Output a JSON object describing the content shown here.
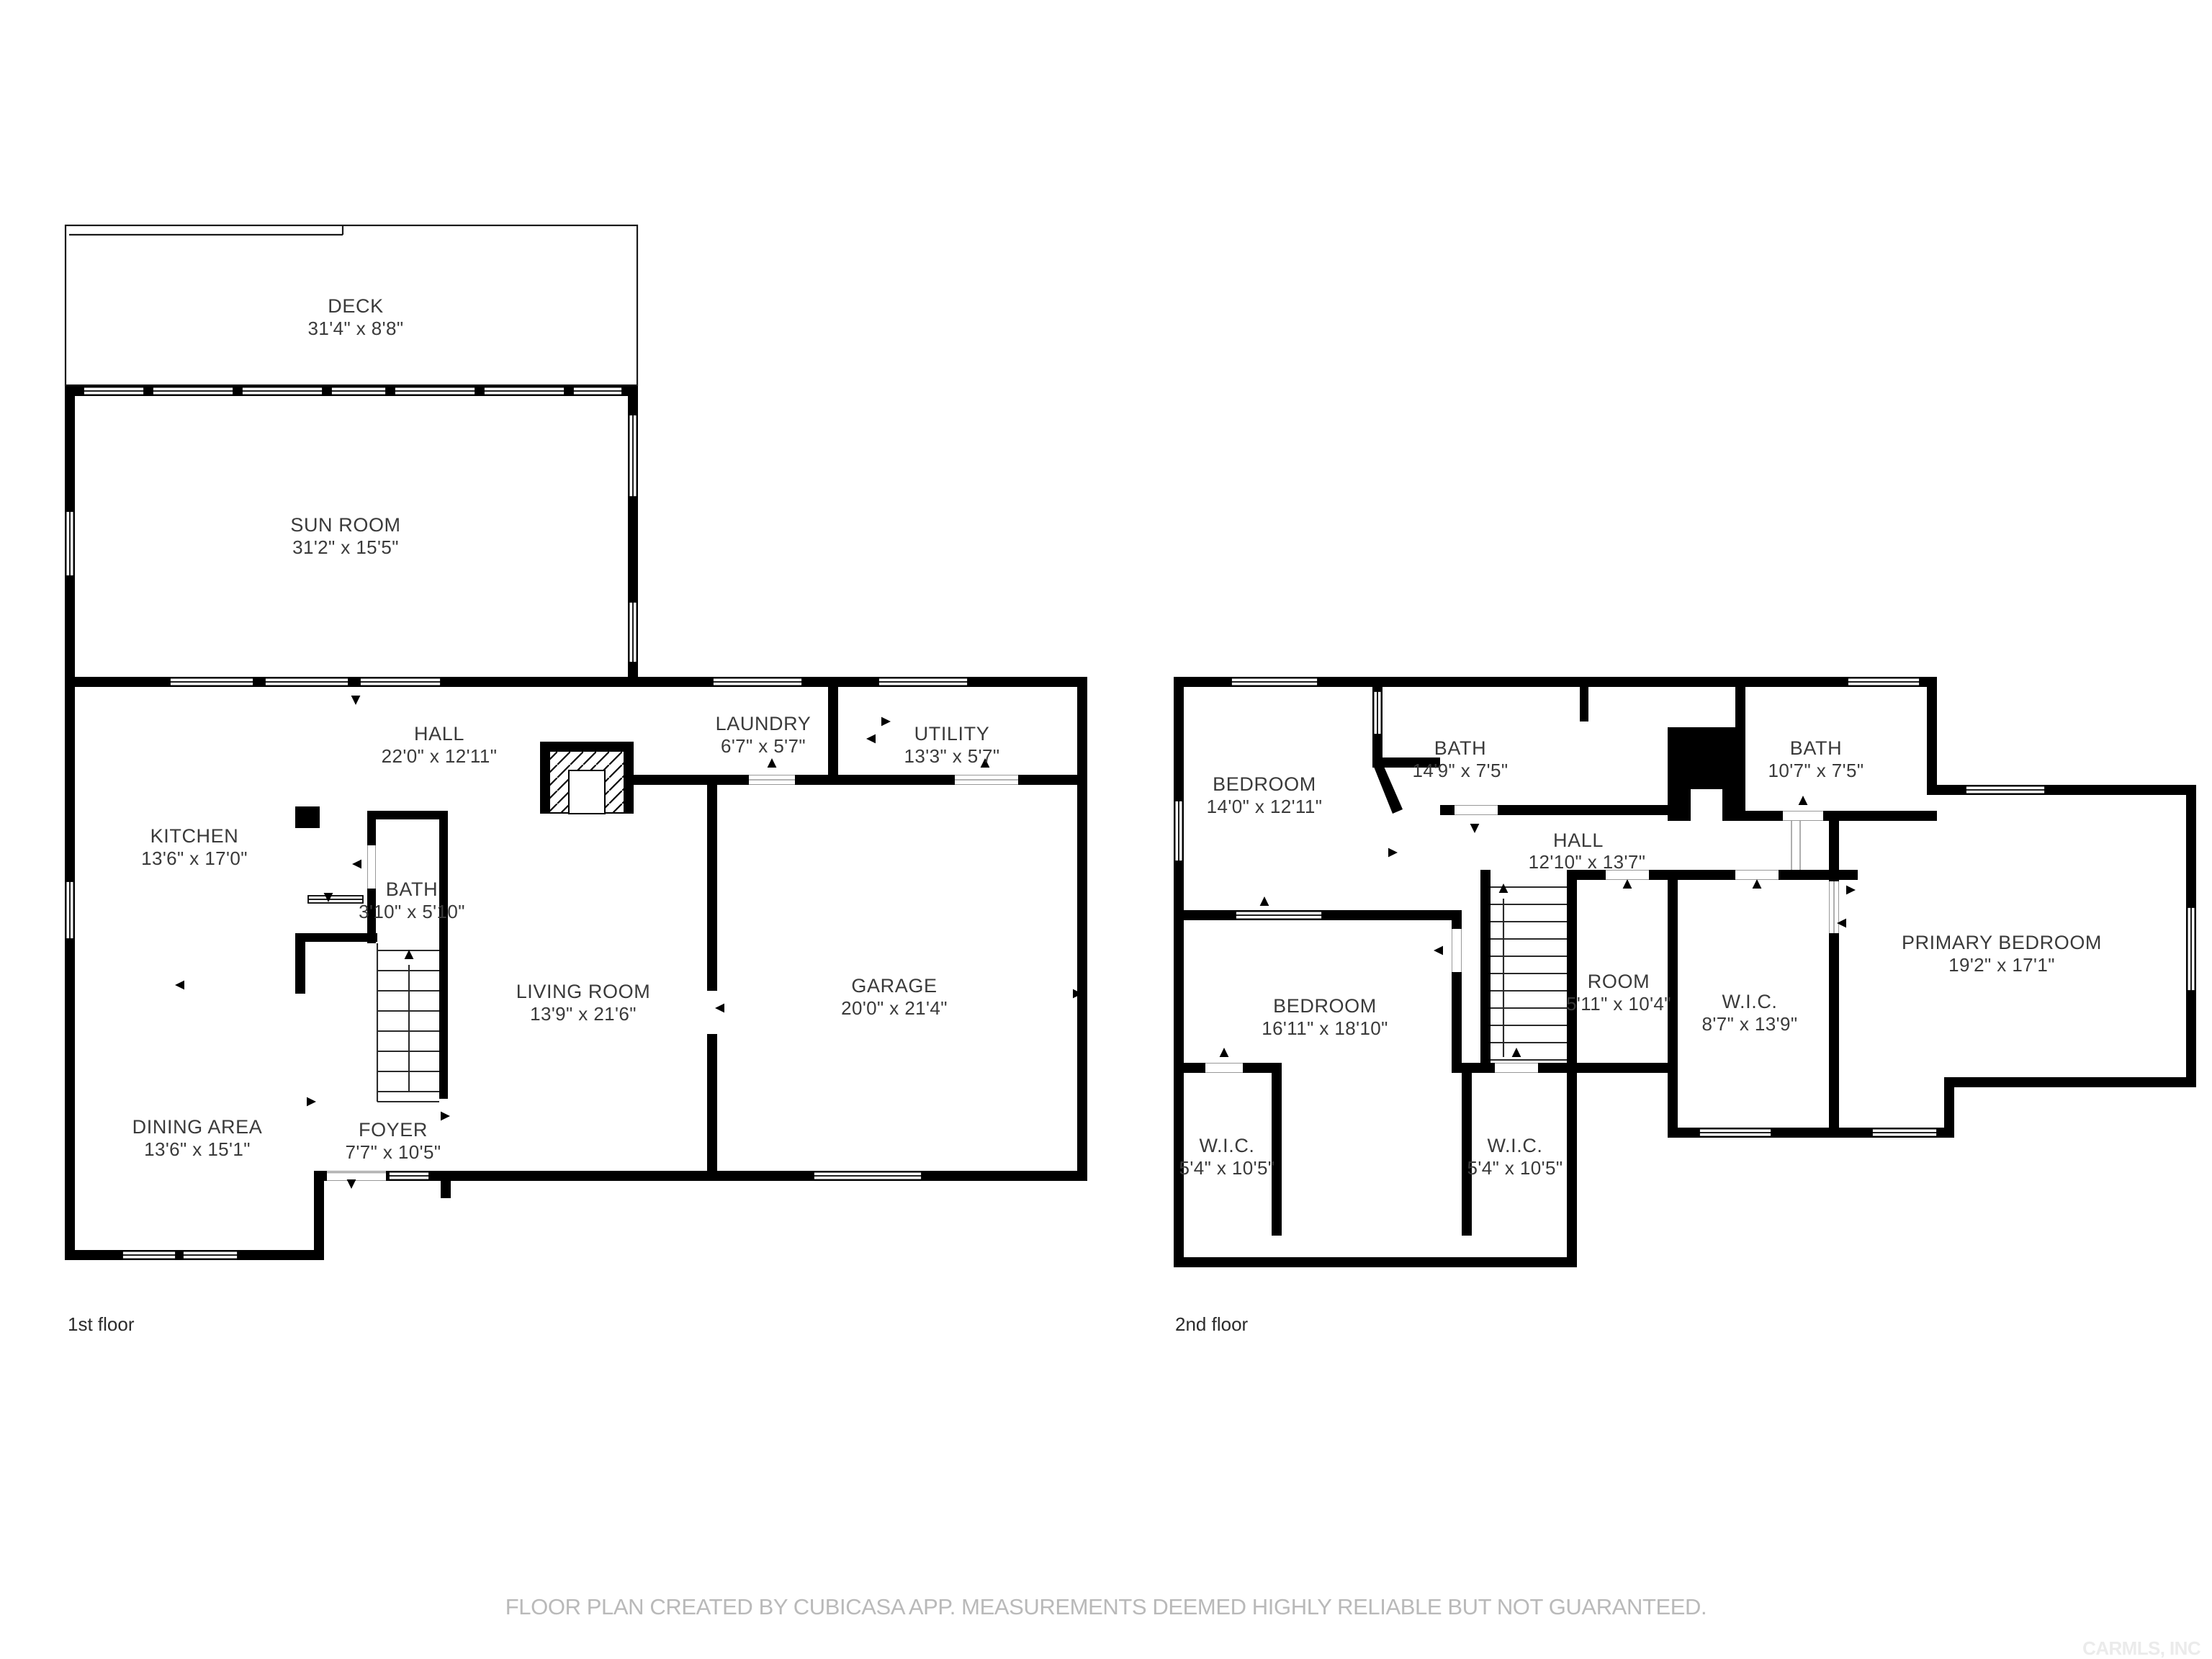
{
  "page": {
    "background": "#ffffff",
    "wall_color": "#000000",
    "label_color": "#3a3a3a",
    "footer_color": "#b9b9b9",
    "watermark_color": "#ebebeb"
  },
  "footer": {
    "disclaimer": "FLOOR PLAN CREATED BY CUBICASA APP. MEASUREMENTS DEEMED HIGHLY RELIABLE BUT NOT GUARANTEED.",
    "watermark": "CARMLS, INC"
  },
  "floors": [
    {
      "caption": "1st floor",
      "rooms": [
        {
          "name": "DECK",
          "dims": "31'4\" x 8'8\""
        },
        {
          "name": "SUN ROOM",
          "dims": "31'2\" x 15'5\""
        },
        {
          "name": "HALL",
          "dims": "22'0\" x 12'11\""
        },
        {
          "name": "LAUNDRY",
          "dims": "6'7\" x 5'7\""
        },
        {
          "name": "UTILITY",
          "dims": "13'3\" x 5'7\""
        },
        {
          "name": "KITCHEN",
          "dims": "13'6\" x 17'0\""
        },
        {
          "name": "BATH",
          "dims": "3'10\" x 5'10\""
        },
        {
          "name": "LIVING ROOM",
          "dims": "13'9\" x 21'6\""
        },
        {
          "name": "GARAGE",
          "dims": "20'0\" x 21'4\""
        },
        {
          "name": "DINING AREA",
          "dims": "13'6\" x 15'1\""
        },
        {
          "name": "FOYER",
          "dims": "7'7\" x 10'5\""
        }
      ]
    },
    {
      "caption": "2nd floor",
      "rooms": [
        {
          "name": "BEDROOM",
          "dims": "14'0\" x 12'11\""
        },
        {
          "name": "BATH",
          "dims": "14'9\" x 7'5\""
        },
        {
          "name": "BATH",
          "dims": "10'7\" x 7'5\""
        },
        {
          "name": "HALL",
          "dims": "12'10\" x 13'7\""
        },
        {
          "name": "PRIMARY BEDROOM",
          "dims": "19'2\" x 17'1\""
        },
        {
          "name": "ROOM",
          "dims": "5'11\" x 10'4\""
        },
        {
          "name": "W.I.C.",
          "dims": "8'7\" x 13'9\""
        },
        {
          "name": "BEDROOM",
          "dims": "16'11\" x 18'10\""
        },
        {
          "name": "W.I.C.",
          "dims": "5'4\" x 10'5\""
        },
        {
          "name": "W.I.C.",
          "dims": "5'4\" x 10'5\""
        }
      ]
    }
  ]
}
